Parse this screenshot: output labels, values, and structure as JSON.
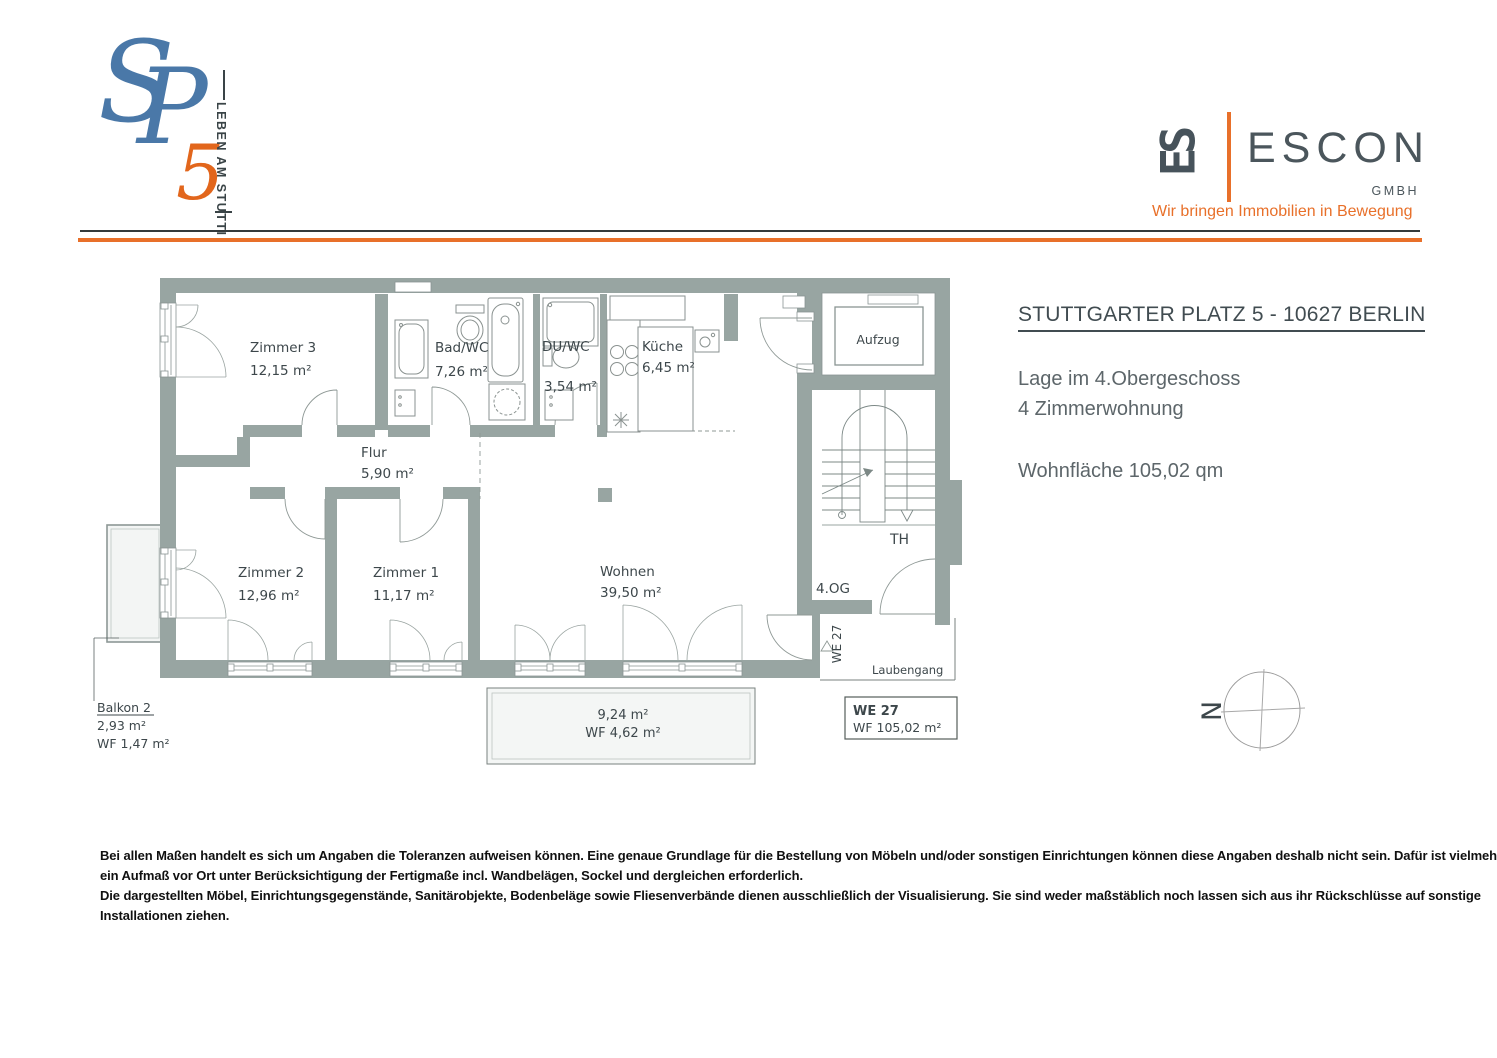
{
  "header": {
    "sp_logo": {
      "s": "S",
      "p": "P",
      "five": "5",
      "vertical_tagline": "LEBEN AM STUTTI"
    },
    "escon": {
      "monogram": "ES",
      "name": "ESCON",
      "legal": "GMBH",
      "tagline": "Wir bringen Immobilien in Bewegung"
    }
  },
  "info": {
    "title": "STUTTGARTER PLATZ 5 - 10627 BERLIN",
    "location_line": "Lage im 4.Obergeschoss",
    "type_line": "4 Zimmerwohnung",
    "area_line": "Wohnfläche 105,02 qm"
  },
  "plan": {
    "rooms": [
      {
        "name": "Zimmer 3",
        "area": "12,15 m²"
      },
      {
        "name": "Bad/WC",
        "area": "7,26 m²"
      },
      {
        "name": "DU/WC",
        "area": "3,54 m²"
      },
      {
        "name": "Küche",
        "area": "6,45 m²"
      },
      {
        "name": "Flur",
        "area": "5,90 m²"
      },
      {
        "name": "Zimmer 2",
        "area": "12,96 m²"
      },
      {
        "name": "Zimmer 1",
        "area": "11,17 m²"
      },
      {
        "name": "Wohnen",
        "area": "39,50 m²"
      }
    ],
    "labels": {
      "aufzug": "Aufzug",
      "th": "TH",
      "og": "4.OG",
      "we_vertical": "WE 27",
      "laubengang": "Laubengang"
    },
    "unit_box": {
      "id": "WE 27",
      "area": "WF 105,02 m²"
    },
    "balkon2": {
      "name": "Balkon 2",
      "area": "2,93 m²",
      "wf": "WF 1,47 m²"
    },
    "balcony_bottom": {
      "area": "9,24 m²",
      "wf": "WF 4,62 m²"
    }
  },
  "compass": {
    "north": "N"
  },
  "disclaimer": {
    "lines": [
      "Bei allen Maßen handelt es sich um Angaben die Toleranzen aufweisen können. Eine genaue Grundlage für die Bestellung von Möbeln und/oder sonstigen Einrichtungen können diese Angaben deshalb nicht sein. Dafür ist vielmehr",
      "ein Aufmaß vor Ort unter Berücksichtigung der Fertigmaße incl. Wandbelägen, Sockel und dergleichen erforderlich.",
      "Die dargestellten Möbel, Einrichtungsgegenstände, Sanitärobjekte, Bodenbeläge sowie Fliesenverbände dienen ausschließlich der Visualisierung. Sie sind weder maßstäblich noch lassen sich aus ihr Rückschlüsse auf sonstige",
      "Installationen ziehen."
    ]
  },
  "colors": {
    "accent_orange": "#e8702a",
    "logo_blue": "#4a78a8",
    "logo_orange": "#e2661c",
    "escon_gray": "#4b565c",
    "wall_gray": "#98a5a2"
  }
}
